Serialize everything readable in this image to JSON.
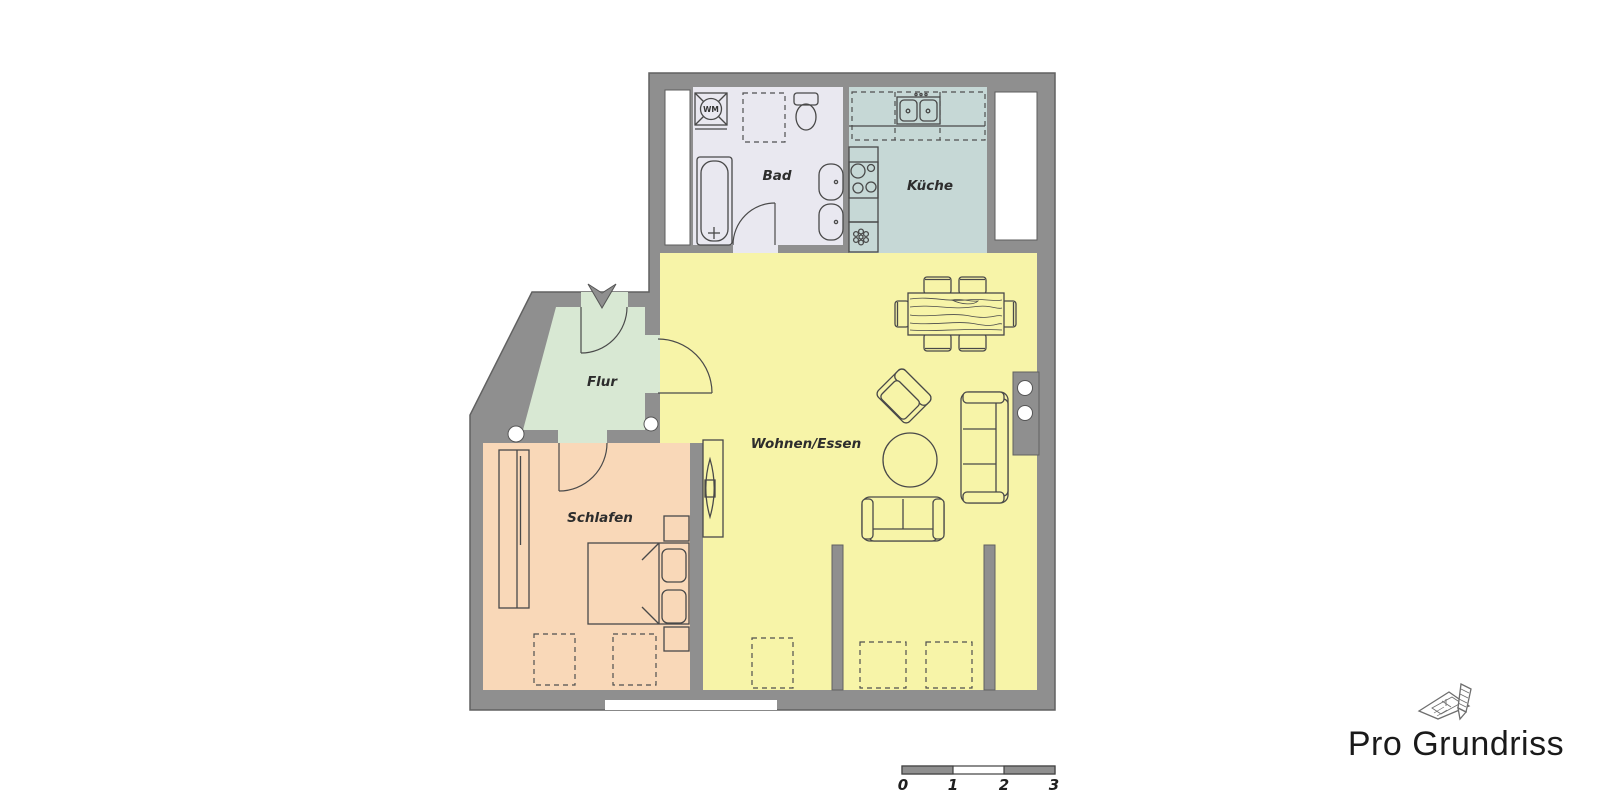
{
  "branding": {
    "logo_text": "Pro Grundriss",
    "logo_color": "#1a1a1a"
  },
  "walls": {
    "color": "#8f8f8f",
    "outline": "#616161"
  },
  "rooms": {
    "bad": {
      "label": "Bad",
      "color": "#e9e8f0"
    },
    "kueche": {
      "label": "Küche",
      "color": "#c6d8d6"
    },
    "flur": {
      "label": "Flur",
      "color": "#d8e8d3"
    },
    "wohnen_essen": {
      "label": "Wohnen/Essen",
      "color": "#f7f4a8"
    },
    "schlafen": {
      "label": "Schlafen",
      "color": "#f9d8b8"
    }
  },
  "fixtures": {
    "washing_machine_label": "WM"
  },
  "scale_bar": {
    "ticks": [
      "0",
      "1",
      "2",
      "3"
    ]
  }
}
